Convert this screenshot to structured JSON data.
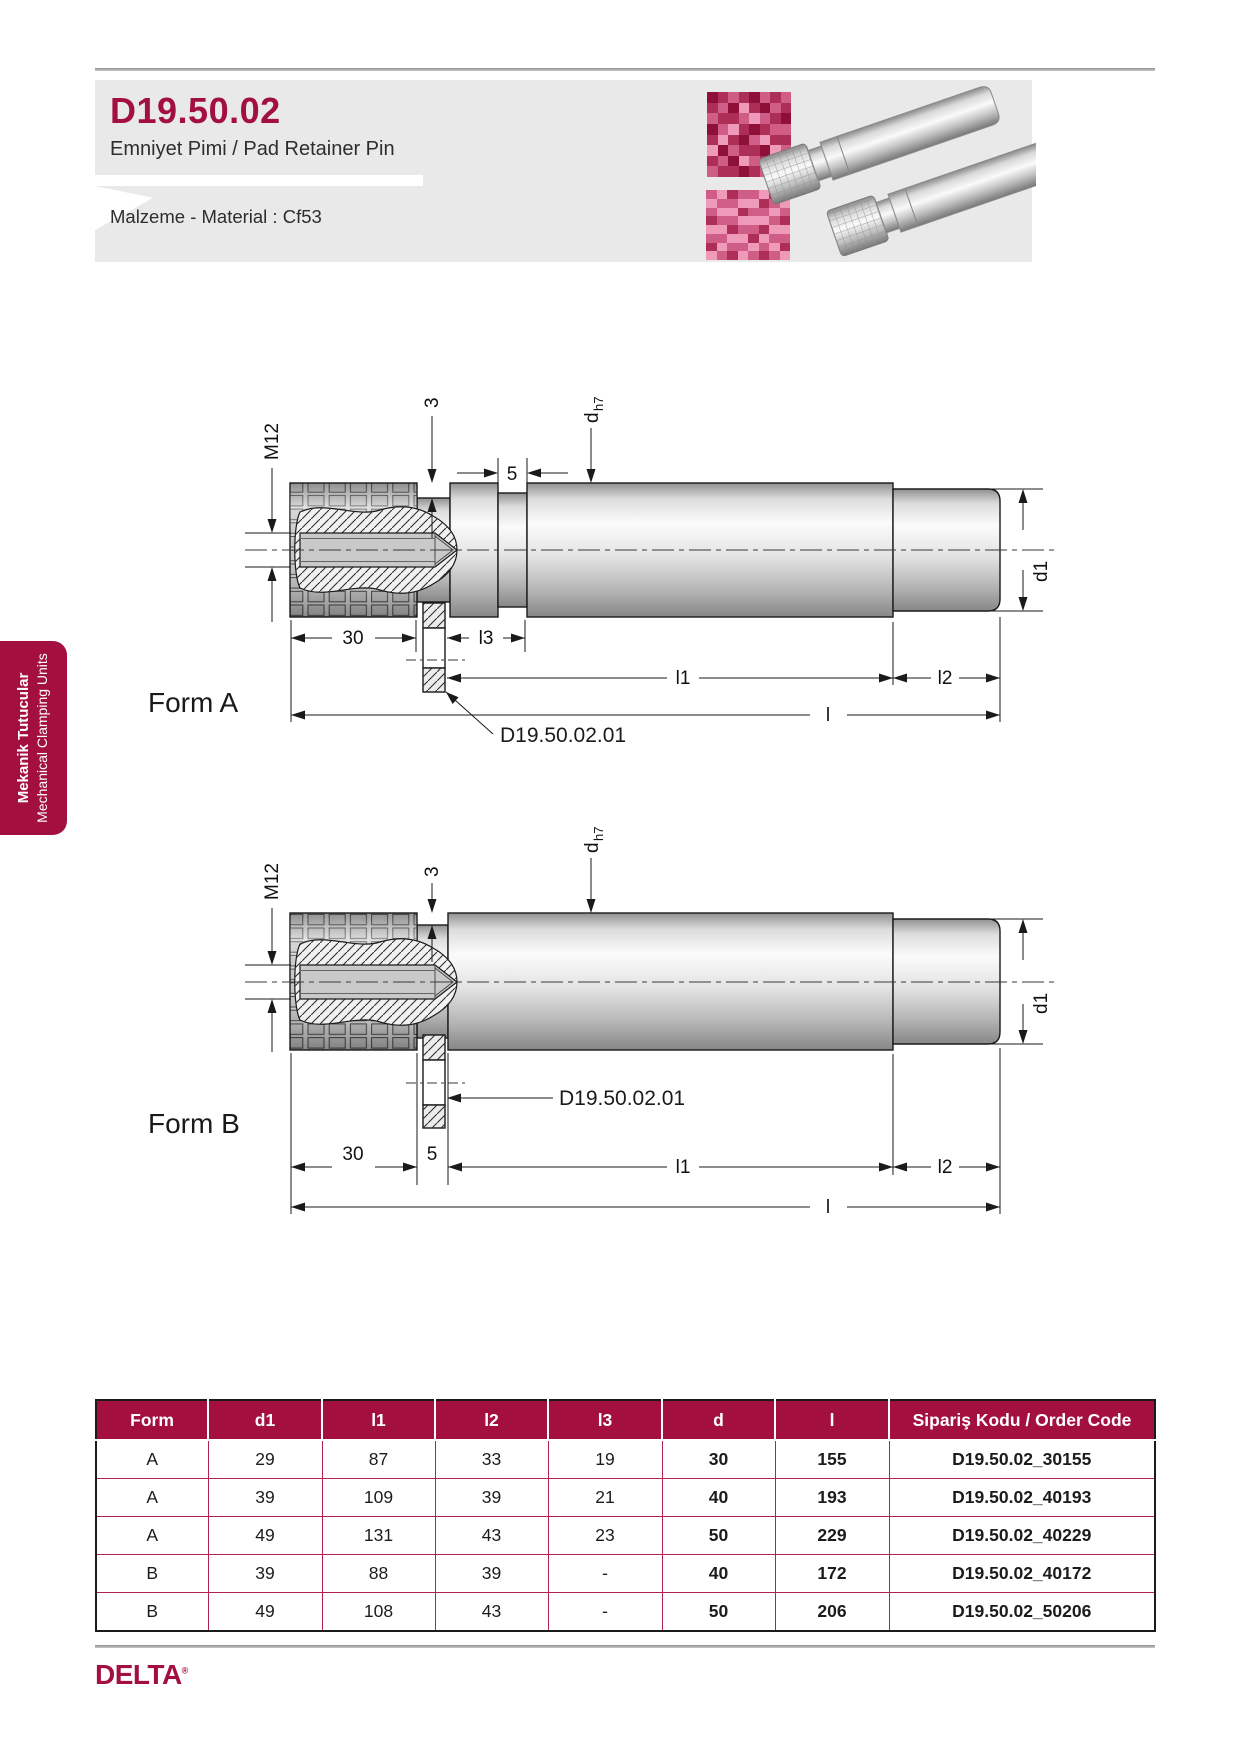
{
  "page": {
    "width": 1241,
    "height": 1755
  },
  "colors": {
    "brand": "#a30f3f",
    "header_bg": "#e9e9e9"
  },
  "header": {
    "code": "D19.50.02",
    "subtitle": "Emniyet Pimi / Pad Retainer Pin",
    "material": "Malzeme - Material : Cf53"
  },
  "sidebar_tab": {
    "line1": "Mekanik Tutucular",
    "line2": "Mechanical Clamping Units"
  },
  "mosaics": {
    "palette": [
      "#8e0f38",
      "#ad2e57",
      "#cf5d86",
      "#ef9ab8"
    ],
    "image1": [
      "01210212",
      "12031021",
      "21123210",
      "02310122",
      "13102311",
      "30211032",
      "12032120",
      "21101231"
    ],
    "image2": [
      "23122312",
      "32233123",
      "23312232",
      "12233321",
      "33122133",
      "22331322",
      "13223231",
      "32132123"
    ]
  },
  "drawings": {
    "form_a_label": "Form A",
    "form_b_label": "Form B",
    "callout": "D19.50.02.01",
    "dims": {
      "m12": "M12",
      "three": "3",
      "five": "5",
      "d_main": "d",
      "d_sub": "h7",
      "d1": "d1",
      "thirty": "30",
      "l3": "l3",
      "l1": "l1",
      "l2": "l2",
      "l": "l"
    }
  },
  "table": {
    "columns": [
      "Form",
      "d1",
      "l1",
      "l2",
      "l3",
      "d",
      "l",
      "Sipariş Kodu / Order Code"
    ],
    "rows": [
      [
        "A",
        "29",
        "87",
        "33",
        "19",
        "30",
        "155",
        "D19.50.02_30155"
      ],
      [
        "A",
        "39",
        "109",
        "39",
        "21",
        "40",
        "193",
        "D19.50.02_40193"
      ],
      [
        "A",
        "49",
        "131",
        "43",
        "23",
        "50",
        "229",
        "D19.50.02_40229"
      ],
      [
        "B",
        "39",
        "88",
        "39",
        "-",
        "40",
        "172",
        "D19.50.02_40172"
      ],
      [
        "B",
        "49",
        "108",
        "43",
        "-",
        "50",
        "206",
        "D19.50.02_50206"
      ]
    ],
    "bold_columns": [
      5,
      6,
      7
    ]
  },
  "footer": {
    "logo": "DELTA",
    "logo_mark": "®"
  }
}
